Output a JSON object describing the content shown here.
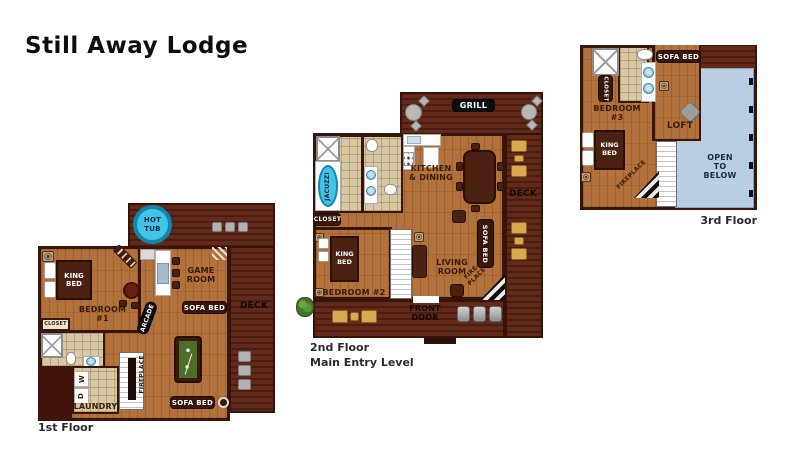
{
  "title": "Still Away Lodge",
  "colors": {
    "deck": "#5a2418",
    "wood": "#b3713b",
    "wall": "#38150b",
    "tile": "#d8c8a4",
    "hot_tub": "#41c4e6",
    "open_below": "#b9cde3",
    "pool_felt": "#4e6d2a",
    "rocker_gold": "#d9a94f"
  },
  "floor1": {
    "name": "1st Floor",
    "hot_tub": "HOT\nTUB",
    "king_bed": "KING\nBED",
    "bedroom": "BEDROOM\n#1",
    "closet": "CLOSET",
    "game_room": "GAME\nROOM",
    "sofa_bed_upper": "SOFA BED",
    "sofa_bed_lower": "SOFA BED",
    "arcade": "ARCADE",
    "deck": "DECK",
    "fireplace": "FIREPLACE",
    "laundry": "LAUNDRY",
    "washer": "W",
    "dryer": "D"
  },
  "floor2": {
    "name": "2nd Floor\nMain Entry Level",
    "grill": "GRILL",
    "jacuzzi": "JACUZZI",
    "closet": "CLOSET",
    "kitchen_dining": "KITCHEN\n& DINING",
    "deck": "DECK",
    "king_bed": "KING\nBED",
    "bedroom": "BEDROOM #2",
    "living_room": "LIVING\nROOM",
    "sofa_bed": "SOFA BED",
    "fireplace": "FIRE-\nPLACE",
    "front_door": "FRONT\nDOOR"
  },
  "floor3": {
    "name": "3rd Floor",
    "sofa_bed": "SOFA BED",
    "closet": "CLOSET",
    "bedroom": "BEDROOM\n#3",
    "king_bed": "KING\nBED",
    "loft": "LOFT",
    "fireplace": "FIREPLACE",
    "open_to_below": "OPEN\nTO\nBELOW"
  }
}
